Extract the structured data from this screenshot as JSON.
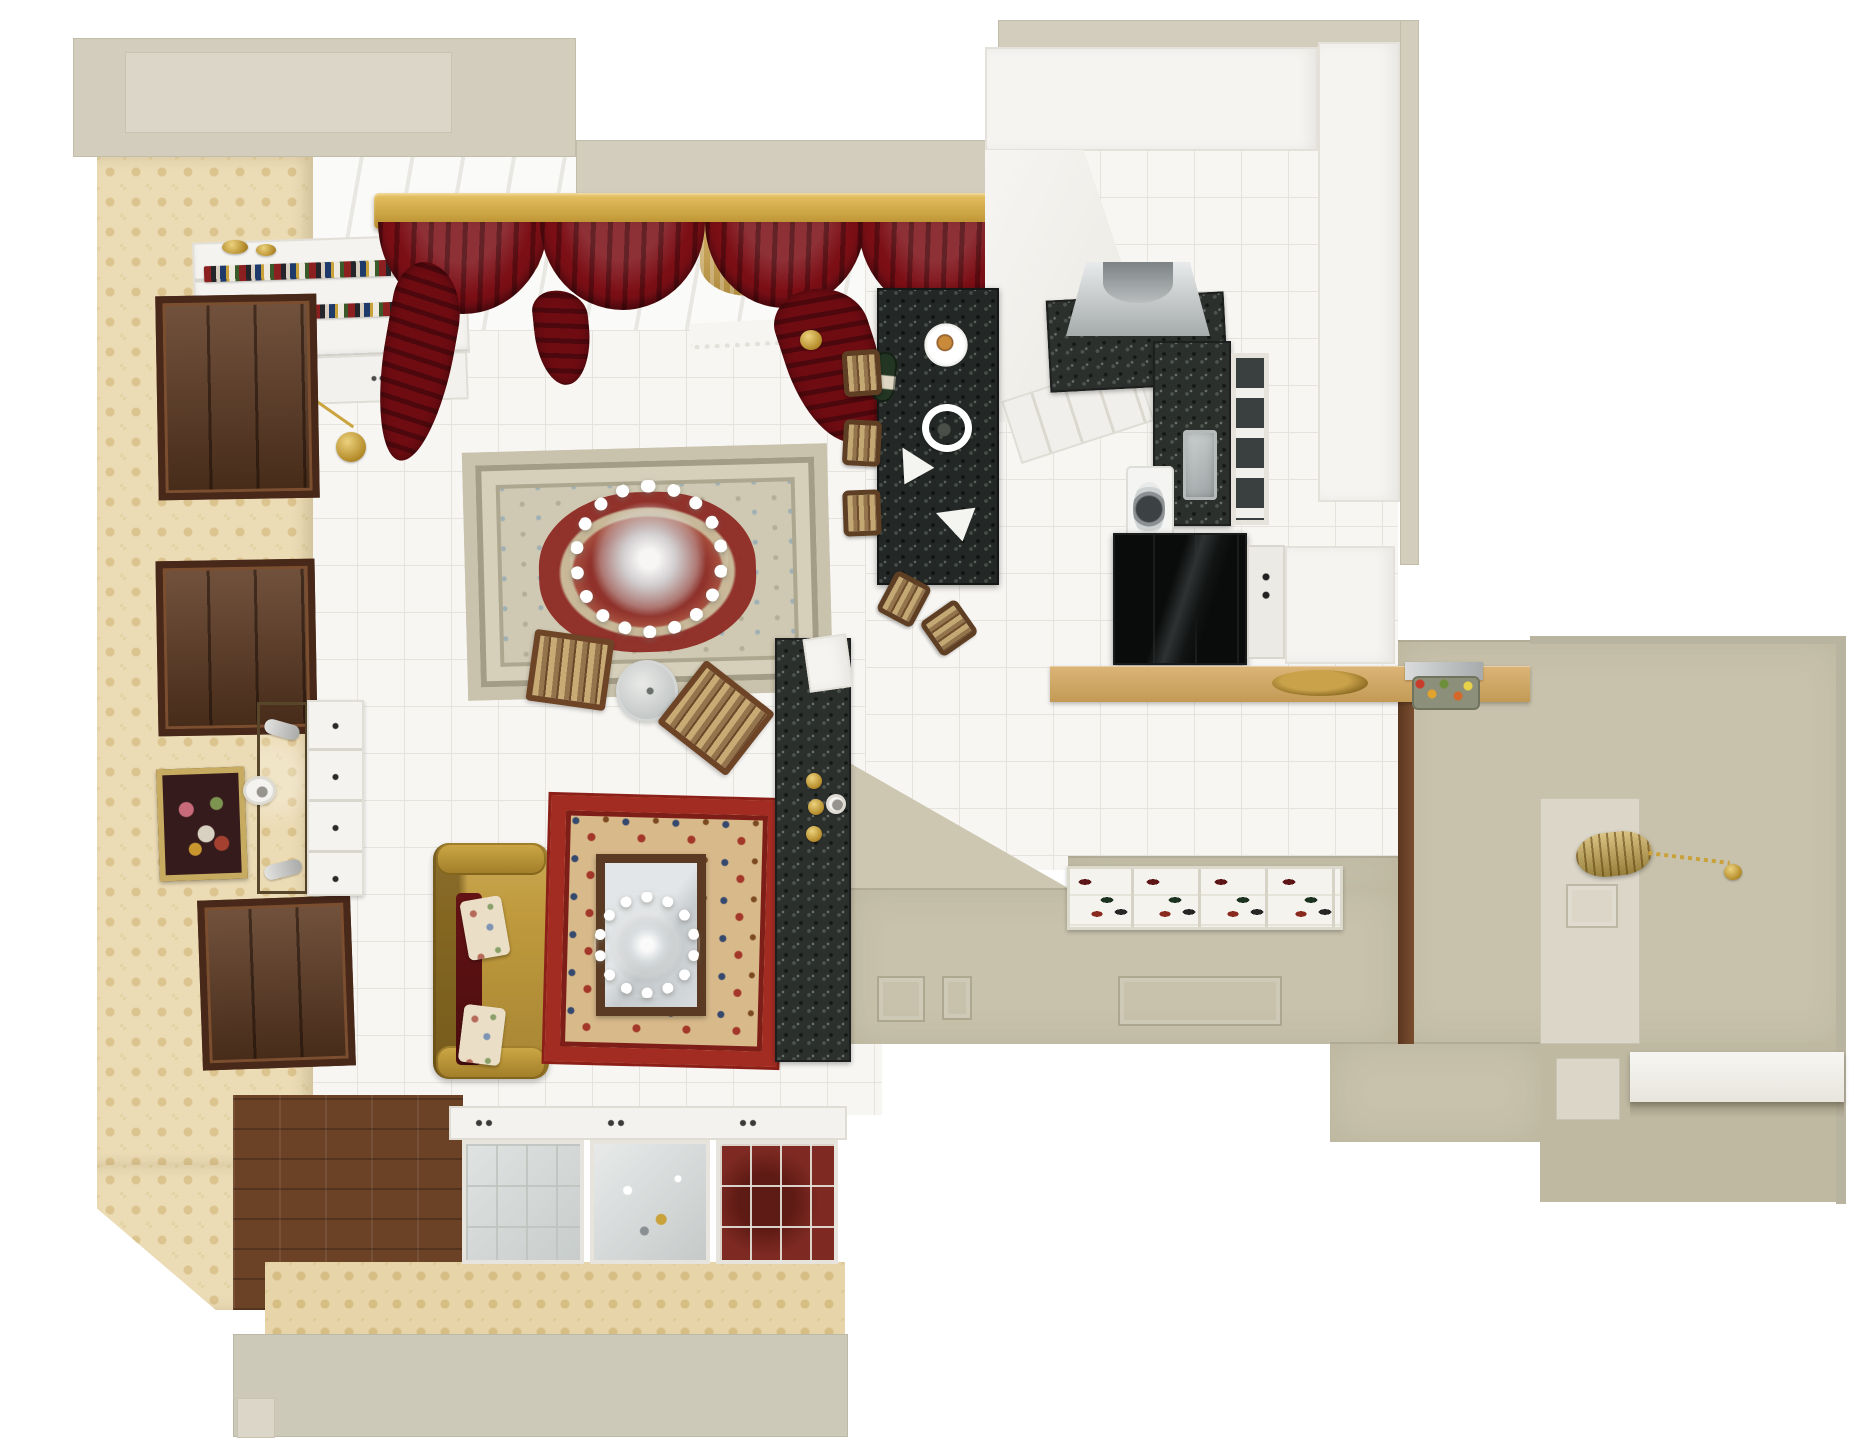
{
  "scene": {
    "label": "Top-down 3D render of a classic apartment floor plan: living room with persian rugs and gold sofa, white kitchen with black granite island, and beige entry hall",
    "canvas": {
      "w": 1864,
      "h": 1440
    },
    "background": "#ffffff"
  },
  "palette": {
    "outer_wall_beige": "#d2cdbd",
    "wallpaper_damask": "#ecdcb6",
    "tile_floor": "#f7f6f3",
    "dark_wood": "#5e3a22",
    "curtain_red": "#7c0f16",
    "pelmet_gold": "#c49738",
    "sofa_gold": "#c09a3c",
    "rug_main_cream": "#cfc8b2",
    "rug_main_red": "#8e2a24",
    "rug_small_red": "#a32c22",
    "granite_black": "#232725",
    "kitchen_white": "#f5f4f1",
    "counter_tan": "#d0a863",
    "hall_beige": "#c8c2ac",
    "accent_gold": "#c9a23c"
  },
  "objects": [
    {
      "n": "window-wall-backdrop",
      "c": "winback",
      "x": 313,
      "y": 157,
      "w": 700,
      "h": 205
    },
    {
      "n": "living-room-tile-floor",
      "c": "tile",
      "x": 310,
      "y": 330,
      "w": 572,
      "h": 785
    },
    {
      "n": "kitchen-tile-floor",
      "c": "tile",
      "x": 865,
      "y": 150,
      "w": 533,
      "h": 720
    },
    {
      "n": "outer-wall-top-left-block",
      "c": "wall",
      "x": 73,
      "y": 38,
      "w": 503,
      "h": 119
    },
    {
      "n": "outer-wall-top-left-inset",
      "c": "wall-light",
      "x": 125,
      "y": 52,
      "w": 327,
      "h": 81
    },
    {
      "n": "outer-wall-top-band",
      "c": "wall",
      "x": 576,
      "y": 140,
      "w": 437,
      "h": 58
    },
    {
      "n": "kitchen-outer-top-strip",
      "c": "wall",
      "x": 998,
      "y": 20,
      "w": 421,
      "h": 28
    },
    {
      "n": "kitchen-outer-right-strip",
      "c": "wall",
      "x": 1400,
      "y": 20,
      "w": 19,
      "h": 545
    },
    {
      "n": "left-wall-wallpaper",
      "c": "wallpaper",
      "x": 97,
      "y": 157,
      "w": 216,
      "h": 1008
    },
    {
      "n": "left-wall-wallpaper-corner",
      "c": "wallpaper wp-corner",
      "x": 97,
      "y": 1165,
      "w": 216,
      "h": 145
    },
    {
      "n": "parquet-floor-border",
      "c": "parquet",
      "x": 233,
      "y": 1095,
      "w": 230,
      "h": 215
    },
    {
      "n": "bottom-wall-wallpaper-band",
      "c": "damask",
      "x": 265,
      "y": 1262,
      "w": 580,
      "h": 74
    },
    {
      "n": "bottom-outer-wall-band",
      "c": "wall2",
      "x": 233,
      "y": 1334,
      "w": 615,
      "h": 103
    },
    {
      "n": "bottom-wall-step",
      "c": "wall-light",
      "x": 237,
      "y": 1398,
      "w": 38,
      "h": 40
    },
    {
      "n": "hall-wall-right",
      "c": "hallwall",
      "x": 1398,
      "y": 640,
      "w": 447,
      "h": 404
    },
    {
      "n": "hall-wall-corner-wedge",
      "c": "halltri",
      "x": 848,
      "y": 762,
      "w": 220,
      "h": 126
    },
    {
      "n": "hall-wall-south",
      "c": "hallwall",
      "x": 848,
      "y": 888,
      "w": 550,
      "h": 156
    },
    {
      "n": "hall-wall-behind-shoecab",
      "c": "hallwall",
      "x": 1068,
      "y": 856,
      "w": 330,
      "h": 34
    },
    {
      "n": "hall-corridor-lower-wall",
      "c": "hallwall2",
      "x": 1540,
      "y": 1042,
      "w": 305,
      "h": 160
    },
    {
      "n": "hall-mid-wall-block",
      "c": "hallwall",
      "x": 1330,
      "y": 1042,
      "w": 212,
      "h": 100
    },
    {
      "n": "hall-pony-wall",
      "c": "wall-light",
      "x": 1540,
      "y": 798,
      "w": 100,
      "h": 246
    },
    {
      "n": "hall-pony-wall-cutout",
      "c": "panelsq",
      "x": 1566,
      "y": 884,
      "w": 52,
      "h": 44
    },
    {
      "n": "hall-corridor-light-square",
      "c": "wall-light",
      "x": 1556,
      "y": 1058,
      "w": 64,
      "h": 62
    },
    {
      "n": "hall-door-frame-strip",
      "c": "woodstrip",
      "x": 1398,
      "y": 700,
      "w": 16,
      "h": 344
    },
    {
      "n": "hall-top-edge",
      "c": "walledge",
      "x": 1530,
      "y": 636,
      "w": 316,
      "h": 8
    },
    {
      "n": "hall-right-outer-edge",
      "c": "walledge",
      "x": 1836,
      "y": 638,
      "w": 10,
      "h": 566
    },
    {
      "n": "bookshelf",
      "c": "bookshelf",
      "x": 194,
      "y": 238,
      "w": 274,
      "h": 120,
      "r": -2
    },
    {
      "n": "bookshelf-books-row-1",
      "c": "bookrow",
      "x": 204,
      "y": 262,
      "w": 250,
      "h": 16,
      "r": -2
    },
    {
      "n": "bookshelf-books-row-2",
      "c": "bookrow",
      "x": 208,
      "y": 304,
      "w": 252,
      "h": 14,
      "r": -2
    },
    {
      "n": "bookshelf-lower-cabinet",
      "c": "shelfcab",
      "x": 194,
      "y": 356,
      "w": 274,
      "h": 48,
      "r": -2
    },
    {
      "n": "shelf-gold-vase-1",
      "c": "golddisc",
      "x": 222,
      "y": 240,
      "w": 26,
      "h": 14
    },
    {
      "n": "shelf-gold-vase-2",
      "c": "golddisc",
      "x": 256,
      "y": 244,
      "w": 20,
      "h": 12
    },
    {
      "n": "wall-clock-face",
      "c": "clockface",
      "x": 239,
      "y": 357,
      "w": 46,
      "h": 46
    },
    {
      "n": "wall-clock-pendulum-rod",
      "c": "goldline",
      "x": 266,
      "y": 398,
      "w": 96,
      "h": 3,
      "r": 35
    },
    {
      "n": "wall-clock-pendulum-disc",
      "c": "golddisc",
      "x": 336,
      "y": 432,
      "w": 30,
      "h": 30
    },
    {
      "n": "left-wall-door-1",
      "c": "wooddoor",
      "x": 157,
      "y": 295,
      "w": 161,
      "h": 204,
      "r": -1
    },
    {
      "n": "left-wall-door-2",
      "c": "wooddoor",
      "x": 157,
      "y": 560,
      "w": 159,
      "h": 175,
      "r": -1
    },
    {
      "n": "left-wall-door-3",
      "c": "wooddoor",
      "x": 200,
      "y": 898,
      "w": 153,
      "h": 170,
      "r": -2
    },
    {
      "n": "bronze-mirror-panel",
      "c": "bronzemirror",
      "x": 257,
      "y": 702,
      "w": 51,
      "h": 192
    },
    {
      "n": "white-dresser",
      "c": "dresser",
      "x": 307,
      "y": 700,
      "w": 57,
      "h": 196
    },
    {
      "n": "framed-painting",
      "c": "painting",
      "x": 158,
      "y": 768,
      "w": 88,
      "h": 112,
      "r": -2
    },
    {
      "n": "mantel-clock",
      "c": "clockface",
      "x": 243,
      "y": 776,
      "w": 33,
      "h": 29
    },
    {
      "n": "wall-sconce-1",
      "c": "sconce",
      "x": 264,
      "y": 722,
      "w": 36,
      "h": 15,
      "r": 16
    },
    {
      "n": "wall-sconce-2",
      "c": "sconce",
      "x": 264,
      "y": 862,
      "w": 38,
      "h": 15,
      "r": -14
    },
    {
      "n": "curtain-pelmet-gold",
      "c": "pelmet",
      "x": 374,
      "y": 193,
      "w": 640,
      "h": 36
    },
    {
      "n": "sheer-curtain-1",
      "c": "sheer",
      "x": 420,
      "y": 226,
      "w": 120,
      "h": 60
    },
    {
      "n": "sheer-curtain-2",
      "c": "sheer",
      "x": 700,
      "y": 226,
      "w": 110,
      "h": 70
    },
    {
      "n": "sheer-curtain-3",
      "c": "sheer",
      "x": 940,
      "y": 226,
      "w": 70,
      "h": 90
    },
    {
      "n": "window-valance",
      "c": "valance",
      "x": 690,
      "y": 320,
      "w": 140,
      "h": 26,
      "r": -3
    },
    {
      "n": "curtain-swag-1",
      "c": "swag",
      "x": 378,
      "y": 222,
      "w": 170,
      "h": 92
    },
    {
      "n": "curtain-swag-2",
      "c": "swag",
      "x": 540,
      "y": 222,
      "w": 165,
      "h": 88
    },
    {
      "n": "curtain-swag-3",
      "c": "swag",
      "x": 705,
      "y": 222,
      "w": 160,
      "h": 86
    },
    {
      "n": "curtain-swag-4",
      "c": "swag",
      "x": 858,
      "y": 222,
      "w": 158,
      "h": 90
    },
    {
      "n": "curtain-tail-left",
      "c": "tail",
      "x": 382,
      "y": 262,
      "w": 70,
      "h": 200,
      "r": 10
    },
    {
      "n": "curtain-tail-mid",
      "c": "tail",
      "x": 535,
      "y": 290,
      "w": 55,
      "h": 95,
      "r": -6
    },
    {
      "n": "curtain-tail-right",
      "c": "tail",
      "x": 788,
      "y": 285,
      "w": 92,
      "h": 160,
      "r": -18
    },
    {
      "n": "curtain-tieback-gold",
      "c": "golddisc",
      "x": 800,
      "y": 330,
      "w": 22,
      "h": 20
    },
    {
      "n": "main-persian-rug",
      "c": "rug1",
      "x": 465,
      "y": 448,
      "w": 365,
      "h": 248,
      "r": -1.5
    },
    {
      "n": "living-chandelier",
      "c": "chand",
      "x": 570,
      "y": 480,
      "w": 158,
      "h": 158
    },
    {
      "n": "round-glass-side-table",
      "c": "glassround",
      "x": 616,
      "y": 660,
      "w": 62,
      "h": 62
    },
    {
      "n": "folding-chair-1",
      "c": "chairfold",
      "x": 530,
      "y": 634,
      "w": 80,
      "h": 72,
      "r": 8
    },
    {
      "n": "folding-chair-2",
      "c": "chairfold",
      "x": 672,
      "y": 678,
      "w": 88,
      "h": 80,
      "r": 38
    },
    {
      "n": "gold-sofa-body",
      "c": "sofabody",
      "x": 433,
      "y": 843,
      "w": 116,
      "h": 236
    },
    {
      "n": "gold-sofa-arm-top",
      "c": "sofaarm",
      "x": 436,
      "y": 843,
      "w": 110,
      "h": 32
    },
    {
      "n": "gold-sofa-arm-bottom",
      "c": "sofaarm",
      "x": 436,
      "y": 1046,
      "w": 110,
      "h": 33
    },
    {
      "n": "sofa-red-throw",
      "c": "throw",
      "x": 456,
      "y": 893,
      "w": 26,
      "h": 172
    },
    {
      "n": "sofa-floral-pillow-1",
      "c": "pillow",
      "x": 464,
      "y": 898,
      "w": 42,
      "h": 60,
      "r": -10
    },
    {
      "n": "sofa-floral-pillow-2",
      "c": "pillow",
      "x": 461,
      "y": 1006,
      "w": 42,
      "h": 58,
      "r": 7
    },
    {
      "n": "small-red-rug",
      "c": "rug2",
      "x": 548,
      "y": 798,
      "w": 232,
      "h": 266,
      "r": 1.5
    },
    {
      "n": "mirror-coffee-table",
      "c": "mirrortable",
      "x": 596,
      "y": 854,
      "w": 110,
      "h": 162
    },
    {
      "n": "coffee-table-chandelier-reflection",
      "c": "chand chand-sm",
      "x": 594,
      "y": 892,
      "w": 106,
      "h": 106
    },
    {
      "n": "granite-console",
      "c": "granite",
      "x": 775,
      "y": 638,
      "w": 76,
      "h": 424
    },
    {
      "n": "console-white-end",
      "c": "whitecol",
      "x": 806,
      "y": 636,
      "w": 44,
      "h": 54,
      "r": -8
    },
    {
      "n": "console-gold-candlestick-1",
      "c": "golddisc",
      "x": 806,
      "y": 773,
      "w": 16,
      "h": 16
    },
    {
      "n": "console-gold-candlestick-2",
      "c": "golddisc",
      "x": 808,
      "y": 799,
      "w": 16,
      "h": 16
    },
    {
      "n": "console-gold-candlestick-3",
      "c": "golddisc",
      "x": 806,
      "y": 826,
      "w": 16,
      "h": 16
    },
    {
      "n": "console-white-sconce",
      "c": "clockface",
      "x": 826,
      "y": 794,
      "w": 20,
      "h": 20
    },
    {
      "n": "china-cabinet-top-band",
      "c": "chinaband",
      "x": 449,
      "y": 1106,
      "w": 398,
      "h": 34
    },
    {
      "n": "china-cabinet-glass-left",
      "c": "chinaA",
      "x": 462,
      "y": 1140,
      "w": 122,
      "h": 124
    },
    {
      "n": "china-cabinet-crystal-middle",
      "c": "chinaB",
      "x": 590,
      "y": 1140,
      "w": 120,
      "h": 124
    },
    {
      "n": "china-cabinet-glass-right",
      "c": "chinaC",
      "x": 716,
      "y": 1140,
      "w": 122,
      "h": 124
    },
    {
      "n": "kitchen-upper-cabinet-band",
      "c": "whitecol",
      "x": 985,
      "y": 47,
      "w": 333,
      "h": 104
    },
    {
      "n": "kitchen-tall-cabinet-column",
      "c": "whitecol",
      "x": 1318,
      "y": 42,
      "w": 82,
      "h": 460
    },
    {
      "n": "kitchen-wall-wedge",
      "c": "whitewedge",
      "x": 985,
      "y": 150,
      "w": 190,
      "h": 272
    },
    {
      "n": "kitchen-paneled-cabinets",
      "c": "panelcab",
      "x": 1008,
      "y": 378,
      "w": 140,
      "h": 66,
      "r": -18
    },
    {
      "n": "kitchen-counter-hood-granite",
      "c": "granite",
      "x": 1048,
      "y": 296,
      "w": 178,
      "h": 92,
      "r": -3
    },
    {
      "n": "range-hood",
      "c": "hood",
      "x": 1066,
      "y": 262,
      "w": 144,
      "h": 74
    },
    {
      "n": "kitchen-counter-right-granite",
      "c": "granite",
      "x": 1153,
      "y": 341,
      "w": 78,
      "h": 185
    },
    {
      "n": "kitchen-sink",
      "c": "sink",
      "x": 1183,
      "y": 430,
      "w": 34,
      "h": 70
    },
    {
      "n": "glass-front-cabinet",
      "c": "glasscab",
      "x": 1231,
      "y": 353,
      "w": 38,
      "h": 172
    },
    {
      "n": "washing-machine",
      "c": "washer",
      "x": 1126,
      "y": 466,
      "w": 48,
      "h": 90
    },
    {
      "n": "black-fridge",
      "c": "fridge",
      "x": 1113,
      "y": 533,
      "w": 134,
      "h": 132
    },
    {
      "n": "cabinet-knob-strip",
      "c": "knobstrip",
      "x": 1247,
      "y": 545,
      "w": 38,
      "h": 114
    },
    {
      "n": "kitchen-white-lower-column",
      "c": "whitecol",
      "x": 1285,
      "y": 546,
      "w": 110,
      "h": 118
    },
    {
      "n": "black-granite-island",
      "c": "granitedark",
      "x": 877,
      "y": 288,
      "w": 122,
      "h": 297
    },
    {
      "n": "wine-bottle",
      "c": "bottle",
      "x": 872,
      "y": 352,
      "w": 24,
      "h": 50,
      "r": 6
    },
    {
      "n": "island-plate-with-food",
      "c": "plate",
      "x": 920,
      "y": 322,
      "w": 52,
      "h": 46
    },
    {
      "n": "island-ring-decor",
      "c": "ringdecor",
      "x": 922,
      "y": 404,
      "w": 50,
      "h": 48
    },
    {
      "n": "island-triangle-plate-1",
      "c": "triplate",
      "x": 896,
      "y": 450,
      "w": 38,
      "h": 36,
      "r": 10
    },
    {
      "n": "island-triangle-plate-2",
      "c": "triplate",
      "x": 940,
      "y": 502,
      "w": 40,
      "h": 38,
      "r": -30
    },
    {
      "n": "bar-stool-1",
      "c": "stool",
      "x": 843,
      "y": 350,
      "w": 38,
      "h": 46,
      "r": -4
    },
    {
      "n": "bar-stool-2",
      "c": "stool",
      "x": 843,
      "y": 420,
      "w": 38,
      "h": 46,
      "r": 3
    },
    {
      "n": "bar-stool-3",
      "c": "stool",
      "x": 843,
      "y": 490,
      "w": 38,
      "h": 46,
      "r": -2
    },
    {
      "n": "bar-stool-4",
      "c": "stool",
      "x": 884,
      "y": 576,
      "w": 40,
      "h": 46,
      "r": 28
    },
    {
      "n": "bar-stool-5",
      "c": "stool",
      "x": 928,
      "y": 606,
      "w": 42,
      "h": 44,
      "r": 55
    },
    {
      "n": "tan-counter-peninsula",
      "c": "countertan",
      "x": 1050,
      "y": 666,
      "w": 480,
      "h": 36
    },
    {
      "n": "gold-serving-tray",
      "c": "goldtray",
      "x": 1272,
      "y": 670,
      "w": 96,
      "h": 26
    },
    {
      "n": "hall-mirror-frame",
      "c": "steel",
      "x": 1405,
      "y": 662,
      "w": 78,
      "h": 18
    },
    {
      "n": "hall-flower-arrangement",
      "c": "flowers",
      "x": 1412,
      "y": 676,
      "w": 68,
      "h": 34
    },
    {
      "n": "hall-shoe-cabinet",
      "c": "shoecab",
      "x": 1067,
      "y": 866,
      "w": 276,
      "h": 64
    },
    {
      "n": "hall-wall-panel-1",
      "c": "panelsq",
      "x": 877,
      "y": 976,
      "w": 48,
      "h": 46
    },
    {
      "n": "hall-wall-panel-2",
      "c": "panelsq",
      "x": 942,
      "y": 976,
      "w": 30,
      "h": 44
    },
    {
      "n": "hall-wall-panel-3",
      "c": "panelsq",
      "x": 1118,
      "y": 976,
      "w": 164,
      "h": 50
    },
    {
      "n": "hall-gold-lantern-pendant",
      "c": "lantern",
      "x": 1576,
      "y": 832,
      "w": 76,
      "h": 44,
      "r": -6
    },
    {
      "n": "lantern-chain",
      "c": "chain",
      "x": 1648,
      "y": 856,
      "w": 82,
      "h": 4,
      "r": 7
    },
    {
      "n": "lantern-chain-knob",
      "c": "golddisc",
      "x": 1724,
      "y": 864,
      "w": 18,
      "h": 16
    },
    {
      "n": "hall-white-shelf",
      "c": "shelfwhite",
      "x": 1630,
      "y": 1052,
      "w": 214,
      "h": 50
    },
    {
      "n": "hall-shelf-shadow",
      "c": "shadowstrip",
      "x": 1630,
      "y": 1102,
      "w": 214,
      "h": 16
    }
  ]
}
